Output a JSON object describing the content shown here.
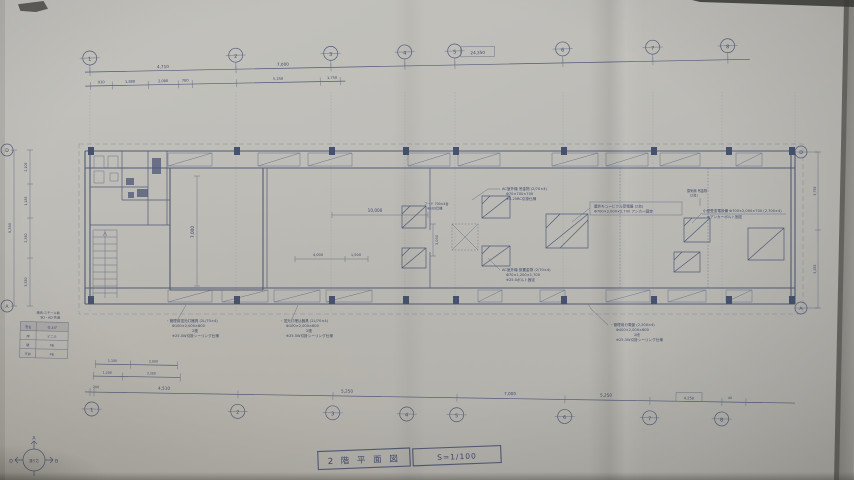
{
  "title_block": {
    "drawing_title": "2 階 平 面 図",
    "scale": "S=1/100"
  },
  "grid": {
    "top_axes": [
      "1",
      "2",
      "3",
      "4",
      "5",
      "6",
      "7",
      "8"
    ],
    "bottom_axes": [
      "1",
      "2",
      "3",
      "4",
      "5",
      "6",
      "7",
      "8"
    ],
    "left_rows": [
      "D",
      "A"
    ],
    "right_rows": [
      "D",
      "A"
    ]
  },
  "dimensions": {
    "overall_boxed": "24,350",
    "top_row1": [
      "4,710",
      "7,000"
    ],
    "top_row2": [
      "910",
      "1,800",
      "2,000",
      "700",
      "5,250",
      "1,750"
    ],
    "bottom_main": [
      "200",
      "4,510",
      "5,250",
      "7,000",
      "5,250"
    ],
    "bottom_boxed": "4,250",
    "bottom_end": "40",
    "bottom_sub1": [
      "1,100",
      "2,000"
    ],
    "bottom_sub2": [
      "1,200",
      "3,300"
    ],
    "left_outer": "9,350",
    "left_chain": [
      "2,105",
      "1,185",
      "2,350",
      "3,550"
    ],
    "right_chain": [
      "3,795",
      "5,555"
    ],
    "hall_length": "10,000",
    "bay_a": "4,000",
    "bay_b": "1,500",
    "shaft_width": "3,000",
    "room_depth": "7,000"
  },
  "annotations": {
    "fluorescent_left": [
      "・管理用蛍光灯器具 (2L/70×4)",
      "Φ100×2,000×600",
      "2連",
      "※25.5W引掛シーリング仕様"
    ],
    "fluorescent_mid": [
      "・蛍光灯埋込器具 (2L/70×4)",
      "Φ100×2,000×600",
      "2連",
      "※25.5W引掛シーリング仕様"
    ],
    "ac_hanger": [
      "AC室外機 吊金物 (2/70×4)",
      "Φ70×700×700",
      "※5.25RC引掛仕様"
    ],
    "cubicle": [
      "屋外キュービクル受電盤 (2台)",
      "Φ700×2,000×2,700 アンカー固定"
    ],
    "switchgear": [
      "小型受変電設備 Φ700×2,000×700 (2,700×4)",
      "※アンカーボルト固定"
    ],
    "vent": [
      "換気扇 吊金物",
      "(2台)"
    ],
    "hood": [
      "フード 700×4台",
      "※SUS仕様"
    ],
    "ac_base": [
      "AC室外機 設置金物 (2/70×4)",
      "Φ70×1,200×1,700",
      "※25.5ボルト固定"
    ],
    "panel": [
      "・管理用分電盤 (2,200×4)",
      "Φ400×2,000×600",
      "2段",
      "※25.5W引掛シーリング仕様"
    ]
  },
  "legend_table": {
    "note_lines": [
      "建具:スチール製",
      "SD・AD 共通"
    ],
    "rows": [
      [
        "室名",
        "仕上げ"
      ],
      [
        "床",
        "ビニル"
      ],
      [
        "壁",
        "PB"
      ],
      [
        "天井",
        "PB"
      ]
    ]
  },
  "compass": {
    "up": "A",
    "right": "B",
    "left": "D",
    "center": "通り芯"
  },
  "colors": {
    "ink": "#4f5a79",
    "paper": "#bcbbb6"
  }
}
